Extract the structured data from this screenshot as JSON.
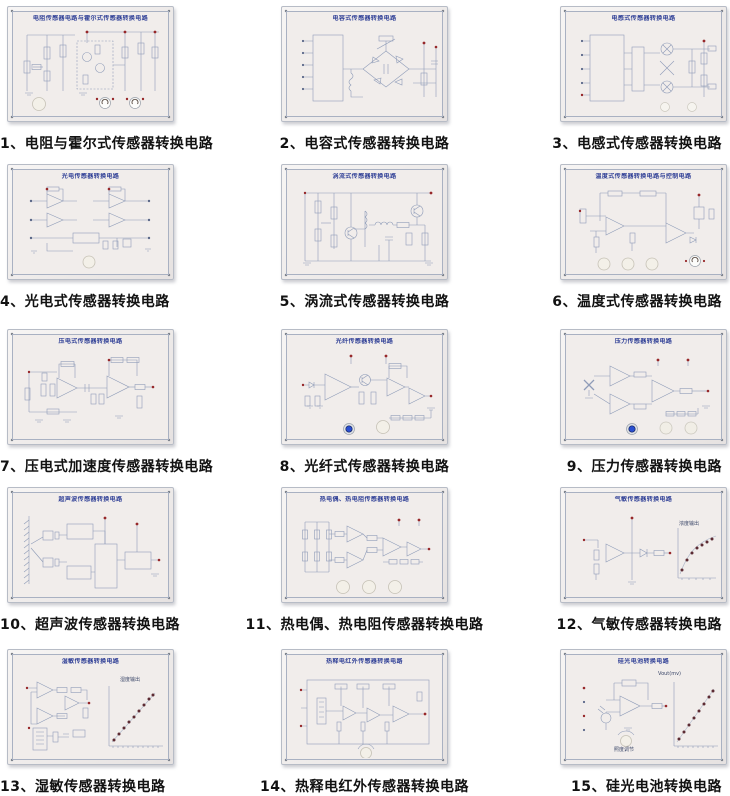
{
  "page": {
    "background": "#ffffff"
  },
  "colors": {
    "panel_title": "#2f3f96",
    "caption_text": "#121212",
    "schematic_line": "#8f9cb8",
    "board_face": "#f1edeb",
    "led_blue": "#2a4fd0",
    "terminal_red": "#97282a",
    "knob_white": "#f3f0e8"
  },
  "panels": [
    {
      "caption": "1、电阻与霍尔式传感器转换电路",
      "panel_title": "电阻传感器电路与霍尔式传感器转换电路"
    },
    {
      "caption": "2、电容式传感器转换电路",
      "panel_title": "电容式传感器转换电路"
    },
    {
      "caption": "3、电感式传感器转换电路",
      "panel_title": "电感式传感器转换电路"
    },
    {
      "caption": "4、光电式传感器转换电路",
      "panel_title": "光电传感器转换电路"
    },
    {
      "caption": "5、涡流式传感器转换电路",
      "panel_title": "涡流式传感器转换电路"
    },
    {
      "caption": "6、温度式传感器转换电路",
      "panel_title": "温度式传感器转换电路与控制电路"
    },
    {
      "caption": "7、压电式加速度传感器转换电路",
      "panel_title": "压电式传感器转换电路"
    },
    {
      "caption": "8、光纤式传感器转换电路",
      "panel_title": "光纤传感器转换电路"
    },
    {
      "caption": "9、压力传感器转换电路",
      "panel_title": "压力传感器转换电路"
    },
    {
      "caption": "10、超声波传感器转换电路",
      "panel_title": "超声波传感器转换电路"
    },
    {
      "caption": "11、热电偶、热电阻传感器转换电路",
      "panel_title": "热电偶、热电阻传感器转换电路"
    },
    {
      "caption": "12、气敏传感器转换电路",
      "panel_title": "气敏传感器转换电路",
      "graph_label": "浓度输出"
    },
    {
      "caption": "13、湿敏传感器转换电路",
      "panel_title": "湿敏传感器转换电路",
      "graph_label": "湿度输出"
    },
    {
      "caption": "14、热释电红外传感器转换电路",
      "panel_title": "热释电红外传感器转换电路"
    },
    {
      "caption": "15、硅光电池转换电路",
      "panel_title": "硅光电池转换电路",
      "graph_label": "Vout(mv)",
      "knob_label": "照度调节"
    }
  ]
}
